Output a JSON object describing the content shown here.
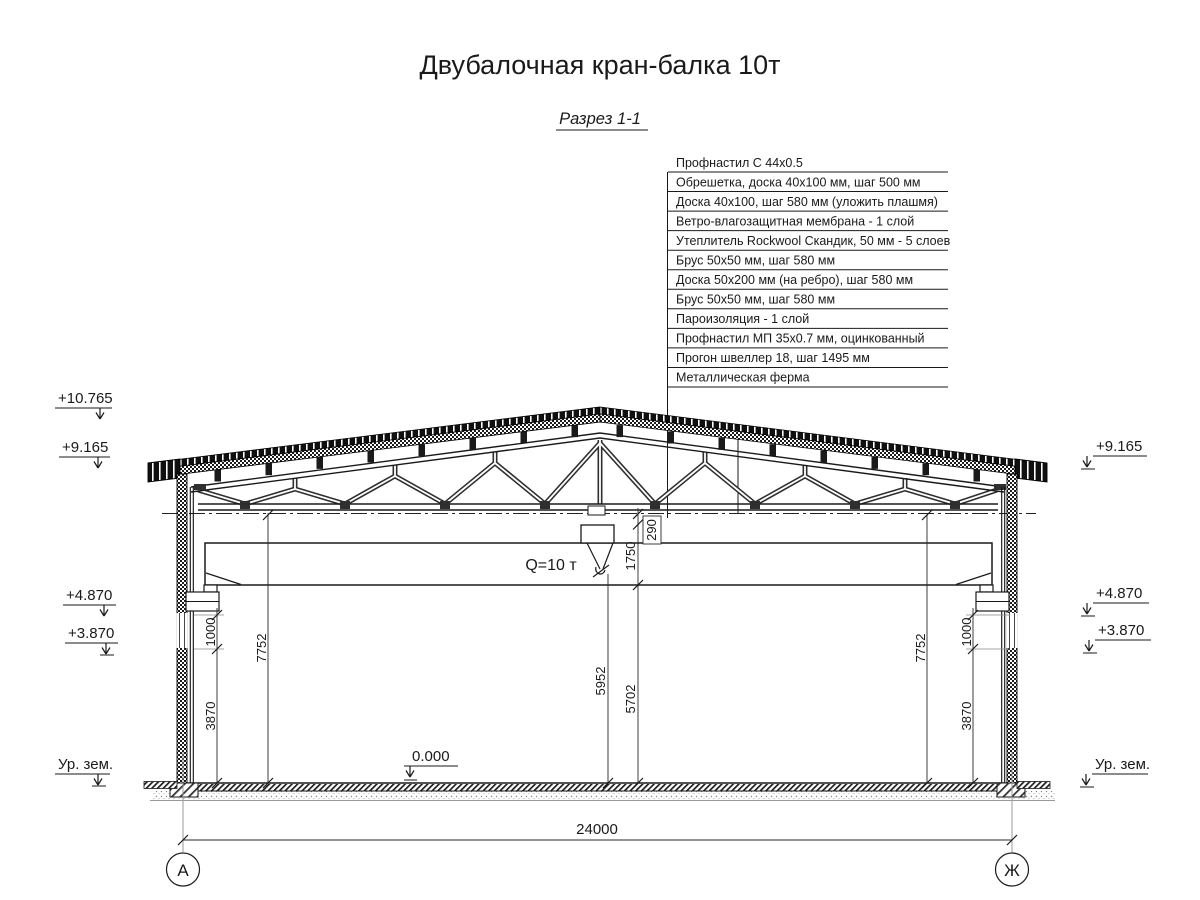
{
  "title": "Двубалочная кран-балка 10т",
  "section_label": "Разрез 1-1",
  "roof_layers": [
    "Профнастил С 44х0.5",
    "Обрешетка, доска 40х100 мм, шаг 500 мм",
    "Доска 40х100, шаг 580 мм (уложить плашмя)",
    "Ветро-влагозащитная мембрана - 1 слой",
    "Утеплитель Rockwool Скандик, 50 мм - 5 слоев",
    "Брус 50х50 мм, шаг 580 мм",
    "Доска 50х200 мм (на ребро), шаг 580 мм",
    "Брус 50х50 мм, шаг 580 мм",
    "Пароизоляция - 1 слой",
    "Профнастил МП 35х0.7 мм, оцинкованный",
    "Прогон швеллер 18, шаг 1495 мм",
    "Металлическая ферма"
  ],
  "crane": {
    "capacity": "Q=10 т"
  },
  "elevations": {
    "ridge": "+10.765",
    "eave_left": "+9.165",
    "eave_right": "+9.165",
    "corbel_left": "+4.870",
    "corbel_right": "+4.870",
    "girt_left": "+3.870",
    "girt_right": "+3.870",
    "ground_left": "Ур. зем.",
    "ground_right": "Ур. зем.",
    "floor_zero": "0.000"
  },
  "dimensions": {
    "span": "24000",
    "truss_clear_left": "7752",
    "truss_clear_right": "7752",
    "corbel_to_girt": "1000",
    "girt_to_floor": "3870",
    "hook_height": "5952",
    "under_girder": "5702",
    "girder_zone": "1750",
    "chord_gap": "290"
  },
  "axes": {
    "left": "А",
    "right": "Ж"
  },
  "colors": {
    "line": "#1a1a1a",
    "dim": "#2a2a2a",
    "aux": "#999999"
  }
}
